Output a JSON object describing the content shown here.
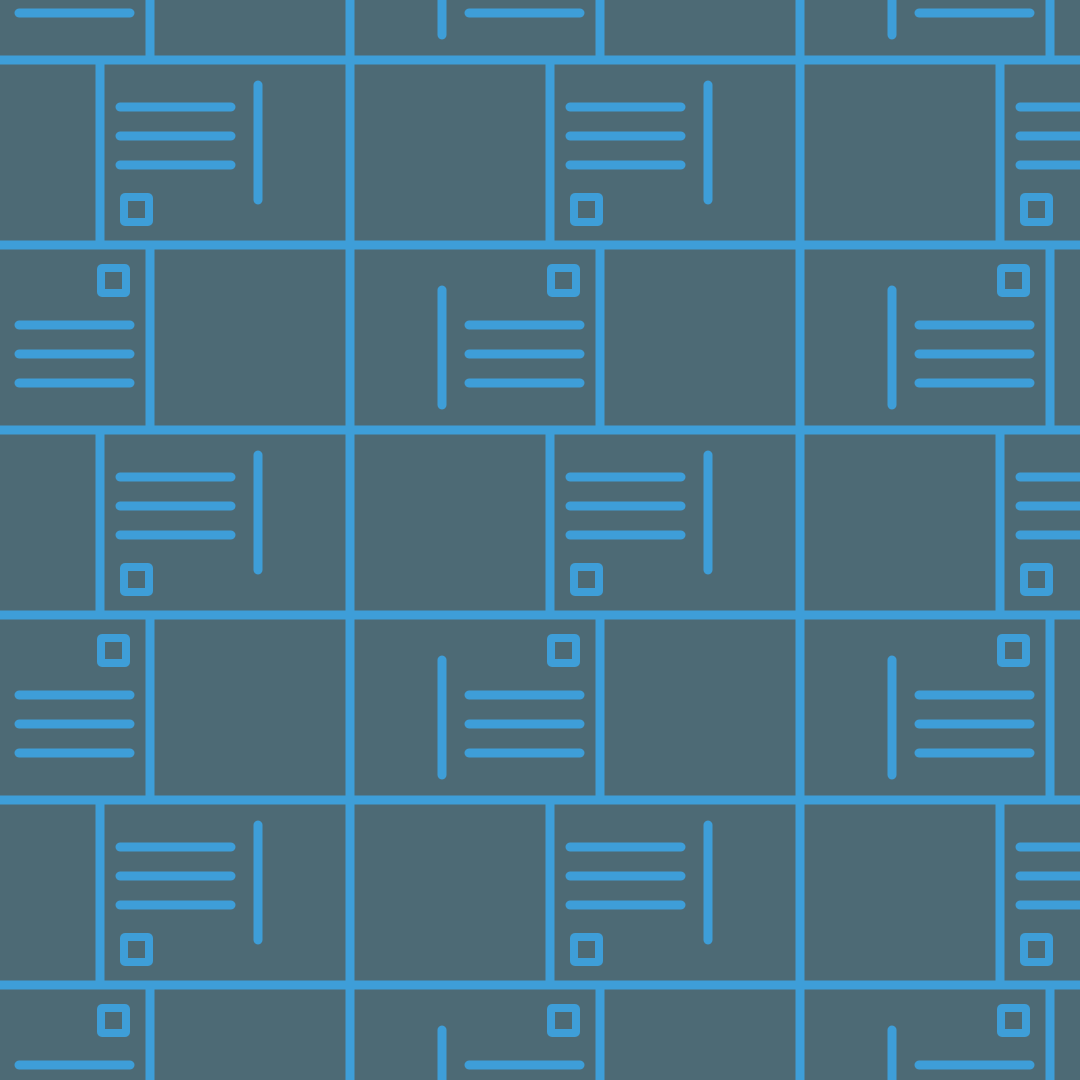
{
  "pattern": {
    "name": "postcard-mail-seamless-pattern",
    "description_label": "Seamless tiled wallpaper pattern of outlined postcards with address lines, a vertical divider line and a stamp square, in blue line art on a slate background",
    "colors": {
      "background": "#4D6A75",
      "line": "#3E9ED8"
    },
    "canvas": {
      "width": 1080,
      "height": 1080
    },
    "stroke": {
      "border_width": 9,
      "line_width": 9,
      "stamp_width": 8
    },
    "grid": {
      "origin_x": 100,
      "origin_y": 60,
      "row_height": 185,
      "card_width": 250,
      "gap_width": 200,
      "horizontal_period": 450,
      "row_offset_x": 250,
      "row_start_index": -1,
      "row_end_index": 5,
      "col_start_index": -2,
      "col_end_index": 3
    },
    "card_variants": {
      "a": {
        "orientation": "lines-top-left, divider-right, stamp-bottom-left",
        "lines": {
          "x1": 20,
          "x2": 131,
          "ys": [
            47,
            76,
            105
          ]
        },
        "vline": {
          "x": 158,
          "y1": 25,
          "y2": 140
        },
        "stamp": {
          "x": 24,
          "y": 137,
          "size": 25
        }
      },
      "b": {
        "orientation": "divider-left, lines-bottom-right, stamp-top-right",
        "lines": {
          "x1": 119,
          "x2": 230,
          "ys": [
            80,
            109,
            138
          ]
        },
        "vline": {
          "x": 92,
          "y1": 45,
          "y2": 160
        },
        "stamp": {
          "x": 201,
          "y": 23,
          "size": 25
        }
      }
    },
    "element_names": [
      "card-border",
      "address-line",
      "divider-line",
      "stamp-icon"
    ]
  }
}
